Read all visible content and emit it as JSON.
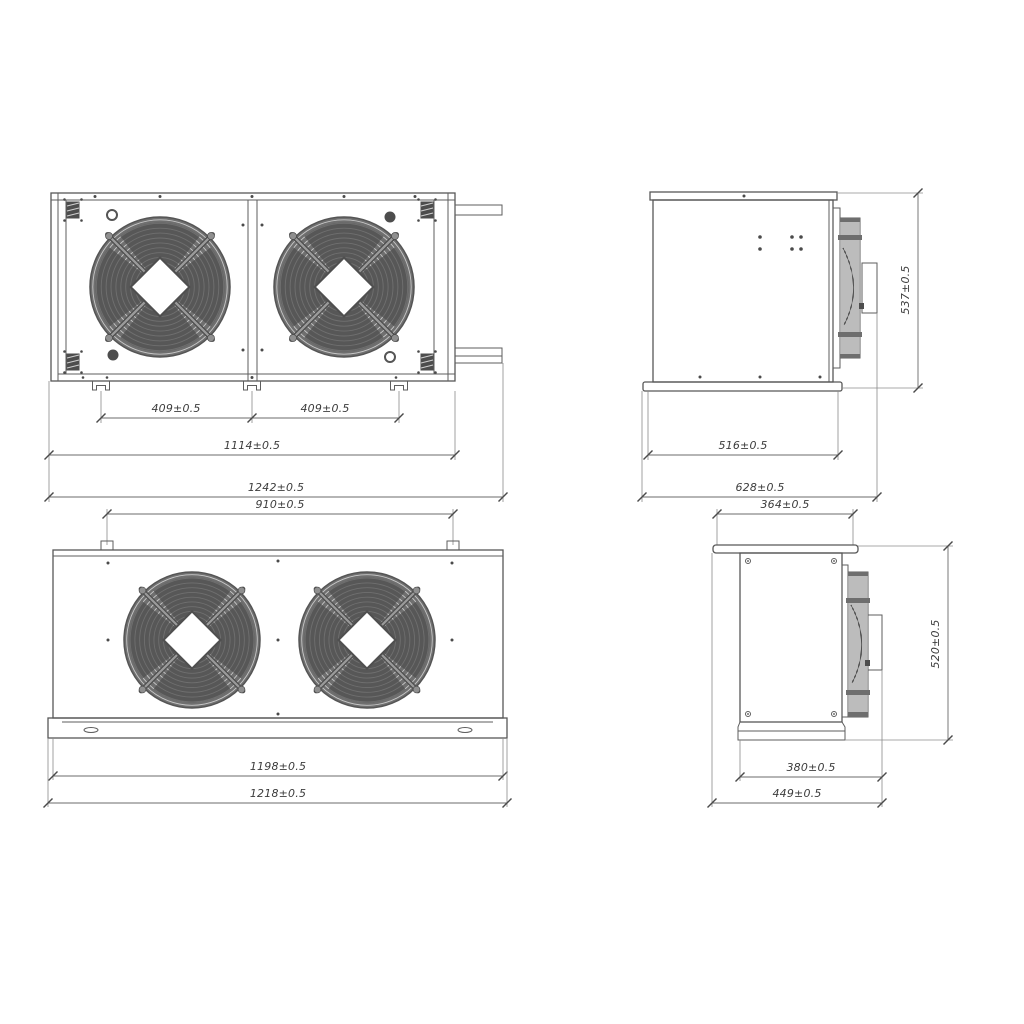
{
  "drawing": {
    "colors": {
      "line": "#575757",
      "fan_fill": "#6f6f6f",
      "background": "#ffffff"
    },
    "views": {
      "front": {
        "dim_fan_pitch_left": "409±0.5",
        "dim_fan_pitch_right": "409±0.5",
        "dim_mounting_width": "1114±0.5",
        "dim_overall_width": "1242±0.5"
      },
      "side_upper": {
        "dim_height": "537±0.5",
        "dim_body_depth": "516±0.5",
        "dim_overall_depth": "628±0.5"
      },
      "top": {
        "dim_mounting_pitch": "910±0.5",
        "dim_body_length": "1198±0.5",
        "dim_overall_length": "1218±0.5"
      },
      "side_lower": {
        "dim_top_plate_width": "364±0.5",
        "dim_height": "520±0.5",
        "dim_body_depth": "380±0.5",
        "dim_overall_depth": "449±0.5"
      }
    }
  }
}
